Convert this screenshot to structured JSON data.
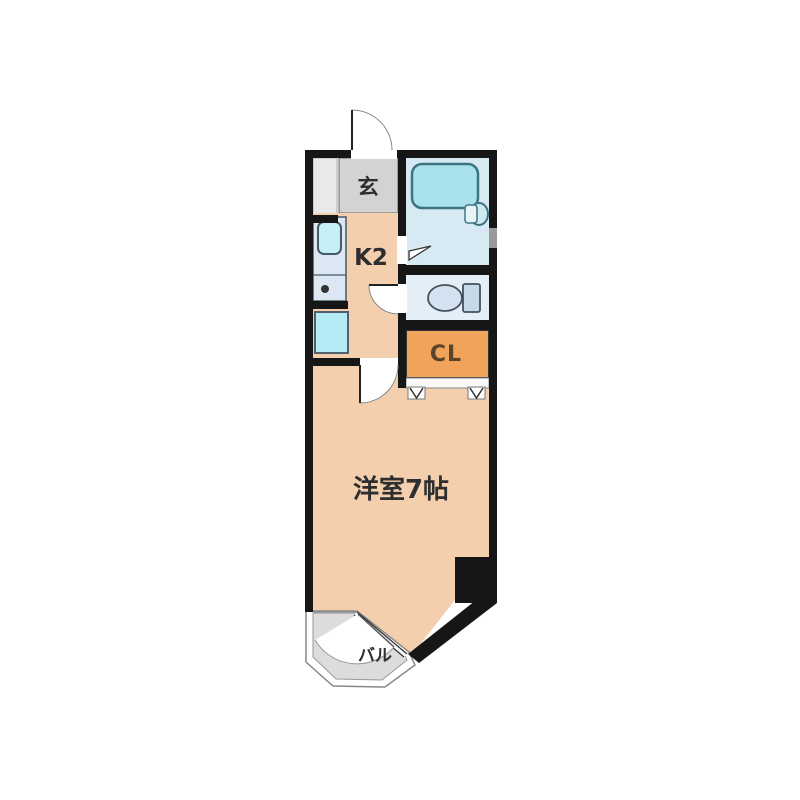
{
  "labels": {
    "entrance": "玄",
    "kitchen": "K2",
    "closet": "CL",
    "main_room": "洋室7帖",
    "balcony": "バル"
  },
  "colors": {
    "wall": "#161616",
    "floor_peach": "#f3cfae",
    "genkan_gray": "#d3d3d3",
    "strip_gray": "#e9e9e9",
    "bath_blue": "#d7eaf3",
    "tub_cyan": "#a9e2ec",
    "toilet_blue": "#e3eef6",
    "closet_orange": "#efa35b",
    "balcony_gray": "#dcdcdc"
  }
}
